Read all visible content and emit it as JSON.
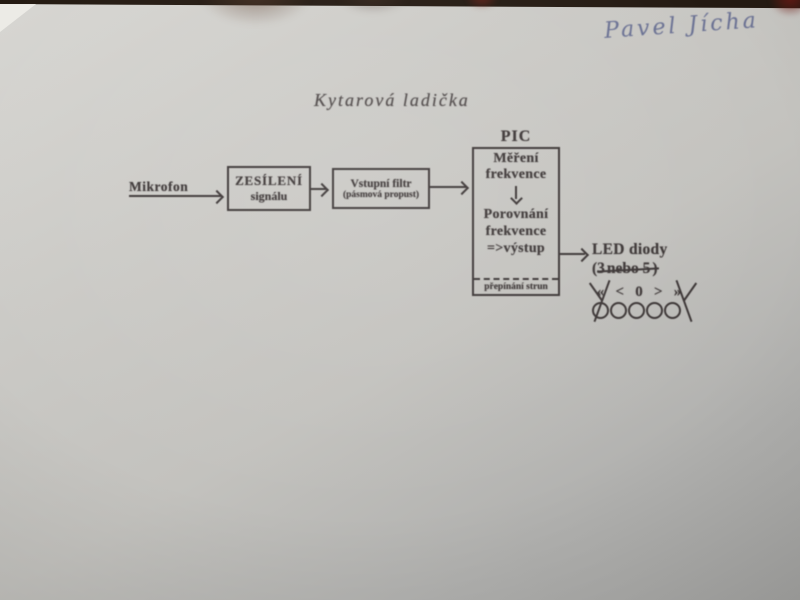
{
  "photo": {
    "handwritten_name": "Pavel Jícha",
    "title": "Kytarová ladička"
  },
  "diagram": {
    "mikrofon_label": "Mikrofon",
    "amp_box": {
      "line1": "ZESÍLENÍ",
      "line2": "signálu"
    },
    "filter_box": {
      "line1": "Vstupní filtr",
      "line2": "(pásmová propust)"
    },
    "pic_box": {
      "label": "PIC",
      "step1_line1": "Měření",
      "step1_line2": "frekvence",
      "step2_line1": "Porovnání",
      "step2_line2": "frekvence",
      "step2_line3": "=>výstup",
      "footer": "přepínání strun"
    },
    "led_group": {
      "title": "LED diody",
      "count_prefix": "(3",
      "count_struck": "nebo 5",
      "count_suffix": ")",
      "symbols": [
        "«",
        "<",
        "0",
        ">",
        "»"
      ],
      "led_count": 5
    }
  },
  "colors": {
    "ink": "#3b3535",
    "pen_blue": "#5c648c",
    "paper_light": "#d7d6d2",
    "paper_dark": "#a4a4a2",
    "background": "#241a12"
  }
}
